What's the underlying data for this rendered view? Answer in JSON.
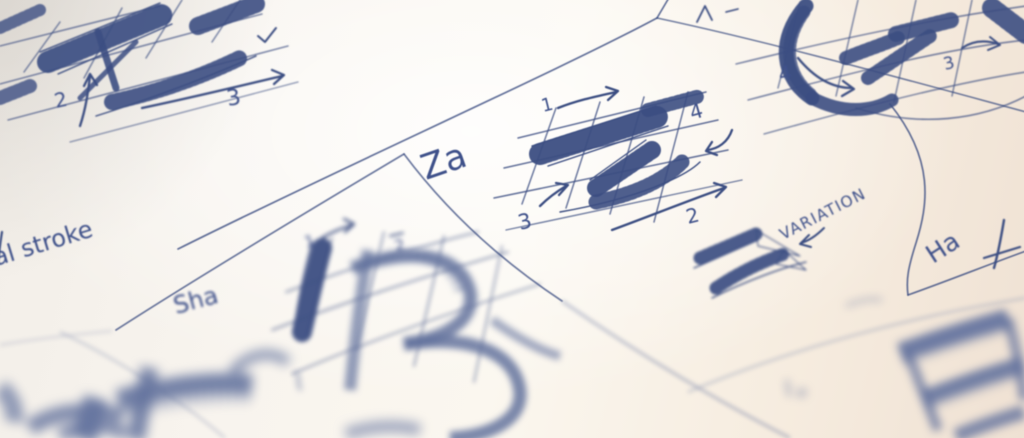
{
  "colors": {
    "ink": "#3c4e82",
    "ink_soft": "#64739e",
    "paper": "#f8f4ee",
    "paper_warm": "#f0e2d4"
  },
  "panels": {
    "top_left": {
      "numbers": {
        "n2": "2",
        "n3": "3"
      }
    },
    "za": {
      "title": "Za",
      "numbers": {
        "n1": "1",
        "n2": "2",
        "n3": "3",
        "n4": "4"
      },
      "variation_label": "VARIATION"
    },
    "top_right": {
      "numbers": {
        "n3": "3",
        "n4": "4"
      }
    },
    "ha": {
      "title": "Ha"
    },
    "sha": {
      "title": "Sha",
      "numbers": {
        "n1": "1",
        "n2": "2"
      }
    },
    "stroke_note": {
      "text": "al stroke"
    }
  }
}
